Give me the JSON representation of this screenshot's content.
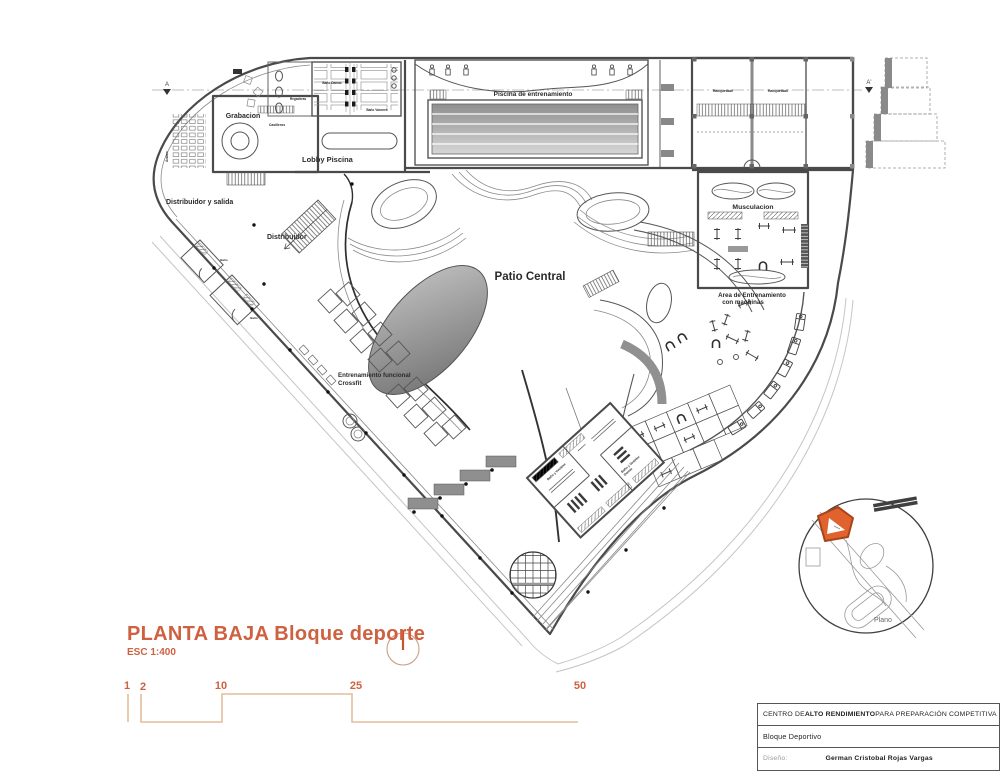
{
  "colors": {
    "accent": "#CE6140",
    "scale_bar": "#E4BD9B",
    "wall": "#4a4a4a",
    "highlight": "#E0622D"
  },
  "plan": {
    "title": "PLANTA BAJA Bloque deporte",
    "scale": "ESC 1:400"
  },
  "scale_bar": {
    "labels": [
      "1",
      "2",
      "10",
      "25",
      "50"
    ]
  },
  "section_markers": {
    "a": "A",
    "a_prime": "A'"
  },
  "rooms": {
    "grabacion": "Grabacion",
    "anden": "Anden",
    "regaderas": "Regaderas",
    "casilleros": "Casilleros",
    "bano_damas": "Baño Damas",
    "bano_varones": "Baño Varones",
    "lobby_piscina": "Lobby Piscina",
    "piscina": "Piscina de entrenamiento",
    "racquetball_1": "Racquetball",
    "racquetball_2": "Racquetball",
    "distribuidor_salida": "Distribuidor y salida",
    "distribuidor": "Distribuidor",
    "patio_central": "Patio Central",
    "musculacion": "Musculacion",
    "area_maquinas_l1": "Area de Entrenamiento",
    "area_maquinas_l2": "con maquinas",
    "crossfit_l1": "Entrenamiento funcional",
    "crossfit_l2": "Crossfit",
    "bano_vestidor_1": "Baño y Vestidor",
    "bano_vestidor_2": "Baño y Vestidor",
    "bano_vestidor_2_sub": "Damas",
    "bano_small_1": "Baño",
    "bano_small_2": "Baño"
  },
  "keyplan": {
    "label": "Plano"
  },
  "titleblock": {
    "row1_pre": "CENTRO DE ",
    "row1_bold": "ALTO RENDIMIENTO",
    "row1_post": " PARA PREPARACIÓN COMPETITIVA",
    "row2": "Bloque Deportivo",
    "row3_label": "Diseño:",
    "row3_value": "German Cristobal  Rojas Vargas"
  }
}
